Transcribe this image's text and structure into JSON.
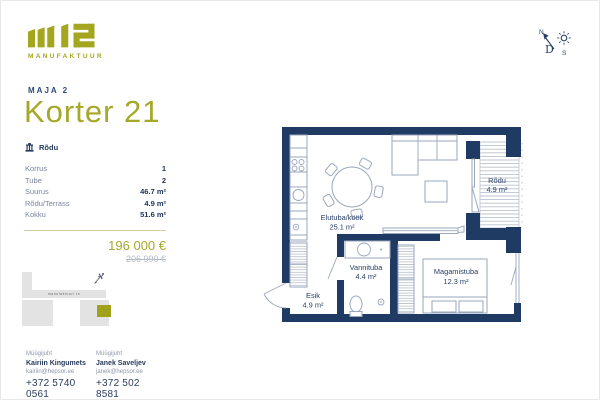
{
  "brand": {
    "name": "m12",
    "sub": "MANUFAKTUUR"
  },
  "header": {
    "project": "MAJA 2",
    "title": "Korter 21"
  },
  "badge": {
    "label": "Rõdu"
  },
  "specs": [
    {
      "label": "Korrus",
      "value": "1"
    },
    {
      "label": "Tube",
      "value": "2"
    },
    {
      "label": "Suurus",
      "value": "46.7 m²"
    },
    {
      "label": "Rõdu/Terrass",
      "value": "4.9 m²"
    },
    {
      "label": "Kokku",
      "value": "51.6 m²"
    }
  ],
  "pricing": {
    "current": "196 000 €",
    "original": "206 990 €"
  },
  "site_plan": {
    "street_label": "manufaktuuri tn"
  },
  "contacts": [
    {
      "role": "Müügijuht",
      "name": "Kairiin Kingumets",
      "email": "kairiin@hepsor.ee",
      "phone": "+372 5740 0561"
    },
    {
      "role": "Müügijuht",
      "name": "Janek Saveljev",
      "email": "janek@hepsor.ee",
      "phone": "+372 502 8581"
    }
  ],
  "floor_plan": {
    "rooms": [
      {
        "name": "Elutuba/köök",
        "area": "25.1 m²"
      },
      {
        "name": "Rõdu",
        "area": "4.9 m²"
      },
      {
        "name": "Vannituba",
        "area": "4.4 m²"
      },
      {
        "name": "Magamistuba",
        "area": "12.3 m²"
      },
      {
        "name": "Esik",
        "area": "4.9 m²"
      }
    ]
  },
  "compass": {
    "north": "N",
    "south": "S",
    "center": "D"
  },
  "colors": {
    "accent": "#a6a82a",
    "navy": "#1f3a63",
    "wall": "#1f3a63",
    "furniture": "#9aa7bd",
    "divider": "#d5cfa3",
    "muted": "#8e96a8"
  }
}
